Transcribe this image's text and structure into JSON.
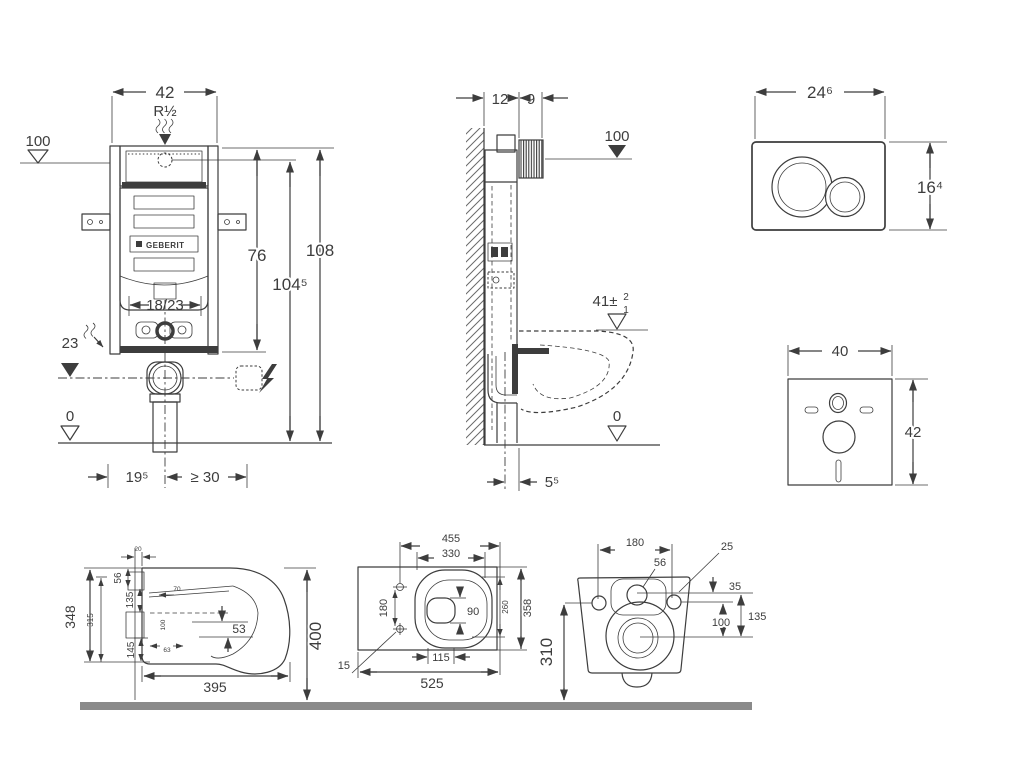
{
  "colors": {
    "line": "#3d3d3d",
    "floor_bar": "#8a8a8a",
    "background": "#ffffff"
  },
  "frame_front": {
    "width": "42",
    "thread": "R½",
    "supply_level": "100",
    "h76": "76",
    "h108": "108",
    "h104": "104⁵",
    "outlet_range": "18/23",
    "bend_height": "23",
    "zero": "0",
    "offset": "19⁵",
    "min_clear": "≥ 30",
    "brand": "GEBERIT"
  },
  "frame_side": {
    "depth": "12",
    "plate_depth": "9",
    "supply_level": "100",
    "pan_top": "41±",
    "tol_plus": "2",
    "tol_minus": "1",
    "zero": "0",
    "outlet_offset": "5⁵"
  },
  "flush_plate": {
    "width": "24⁶",
    "height": "16⁴"
  },
  "sound_mat": {
    "width": "40",
    "height": "42"
  },
  "wc_side": {
    "d20": "20",
    "d56": "56",
    "d135": "135",
    "d315": "315",
    "d348": "348",
    "d145": "145",
    "d70": "70",
    "d100": "100",
    "d63": "63",
    "d53": "53",
    "d395": "395",
    "d400": "400"
  },
  "wc_top": {
    "d455": "455",
    "d330": "330",
    "d180": "180",
    "d90": "90",
    "d260": "260",
    "d358": "358",
    "d115": "115",
    "d15": "15",
    "d525": "525"
  },
  "wc_rear": {
    "d180": "180",
    "d25": "25",
    "d56": "56",
    "d35": "35",
    "d100": "100",
    "d135": "135",
    "d310": "310"
  }
}
